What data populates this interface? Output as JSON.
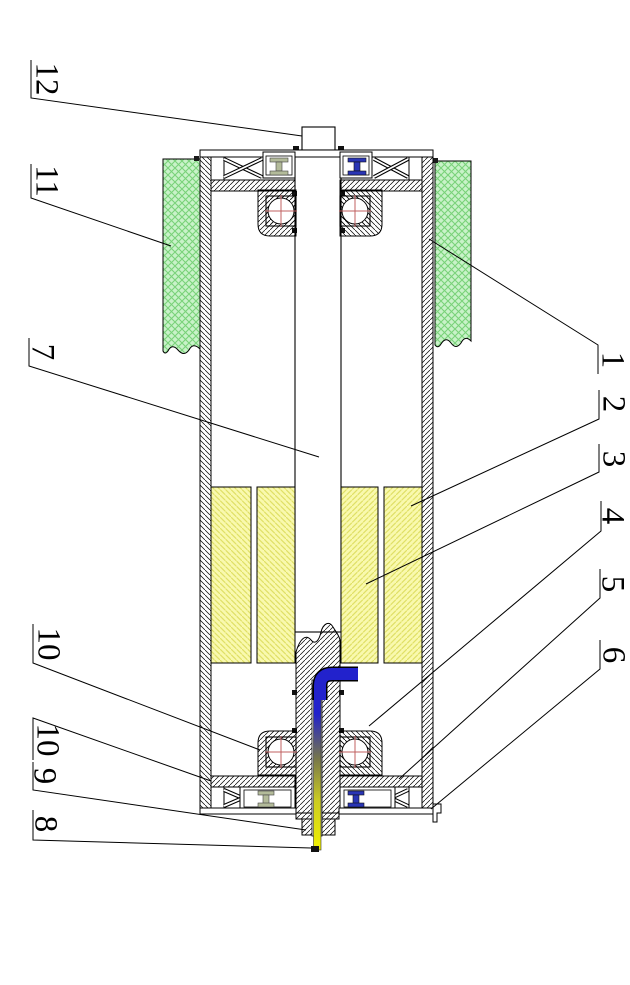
{
  "figure": {
    "kind": "sectional technical drawing of a motorized drum roller, rotated 90 degrees",
    "left_column_labels": [
      "12",
      "11",
      "7",
      "10",
      "10",
      "9",
      "8"
    ],
    "right_column_labels": [
      "1",
      "2",
      "3",
      "4",
      "5",
      "6"
    ]
  },
  "callouts": [
    {
      "text": "12"
    },
    {
      "text": "11"
    },
    {
      "text": "7"
    },
    {
      "text": "10"
    },
    {
      "text": "10"
    },
    {
      "text": "9"
    },
    {
      "text": "8"
    },
    {
      "text": "1"
    },
    {
      "text": "2"
    },
    {
      "text": "3"
    },
    {
      "text": "4"
    },
    {
      "text": "5"
    },
    {
      "text": "6"
    }
  ],
  "colors": {
    "background": "#ffffff",
    "line": "#000000",
    "lagging_green_fill": "#c9f2c9",
    "lagging_green_hatch": "#79d279",
    "winding_yellow_fill": "#f9f9ae",
    "winding_yellow_hatch": "#e0e066",
    "cable_blue": "#2222cc",
    "cable_yellow": "#f0f000",
    "seal_gray": "#b3bb9a",
    "seal_blue": "#2a35b5",
    "bearing_cross_red": "#c06060"
  }
}
